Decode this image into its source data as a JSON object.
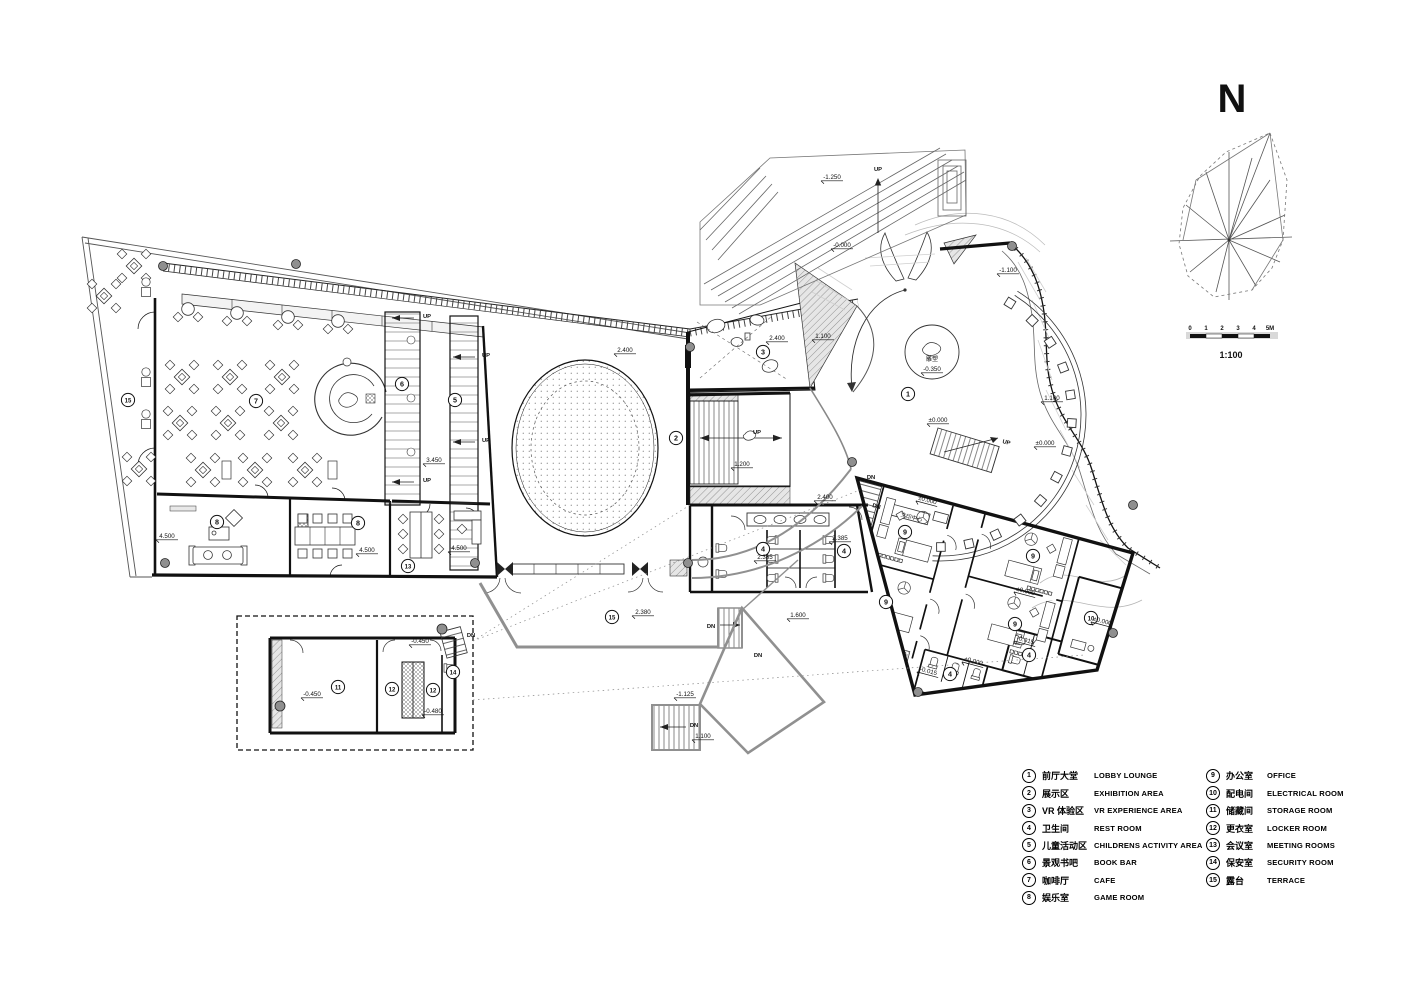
{
  "drawing": {
    "north_label": "N",
    "scale_ratio": "1:100",
    "scale_ticks": [
      "0",
      "1",
      "2",
      "3",
      "4",
      "5M"
    ],
    "colors": {
      "wall": "#1a1a1a",
      "gray_structure": "#909090",
      "light_fill": "#e8e8e8",
      "hatch": "#8a8a8a"
    }
  },
  "legend": {
    "items": [
      {
        "n": "1",
        "zh": "前厅大堂",
        "en": "LOBBY LOUNGE"
      },
      {
        "n": "2",
        "zh": "展示区",
        "en": "EXHIBITION AREA"
      },
      {
        "n": "3",
        "zh": "VR 体验区",
        "en": "VR EXPERIENCE AREA"
      },
      {
        "n": "4",
        "zh": "卫生间",
        "en": "REST ROOM"
      },
      {
        "n": "5",
        "zh": "儿童活动区",
        "en": "CHILDRENS ACTIVITY AREA"
      },
      {
        "n": "6",
        "zh": "景观书吧",
        "en": "BOOK BAR"
      },
      {
        "n": "7",
        "zh": "咖啡厅",
        "en": "CAFE"
      },
      {
        "n": "8",
        "zh": "娱乐室",
        "en": "GAME ROOM"
      },
      {
        "n": "9",
        "zh": "办公室",
        "en": "OFFICE"
      },
      {
        "n": "10",
        "zh": "配电间",
        "en": "ELECTRICAL ROOM"
      },
      {
        "n": "11",
        "zh": "储藏间",
        "en": "STORAGE ROOM"
      },
      {
        "n": "12",
        "zh": "更衣室",
        "en": "LOCKER ROOM"
      },
      {
        "n": "13",
        "zh": "会议室",
        "en": "MEETING ROOMS"
      },
      {
        "n": "14",
        "zh": "保安室",
        "en": "SECURITY ROOM"
      },
      {
        "n": "15",
        "zh": "露台",
        "en": "TERRACE"
      }
    ]
  },
  "plan": {
    "room_markers": [
      {
        "n": "1",
        "x": 908,
        "y": 394
      },
      {
        "n": "2",
        "x": 676,
        "y": 438
      },
      {
        "n": "3",
        "x": 763,
        "y": 352
      },
      {
        "n": "4",
        "x": 763,
        "y": 549
      },
      {
        "n": "4",
        "x": 844,
        "y": 551
      },
      {
        "n": "4",
        "x": 1029,
        "y": 655
      },
      {
        "n": "4",
        "x": 950,
        "y": 674
      },
      {
        "n": "5",
        "x": 455,
        "y": 400
      },
      {
        "n": "6",
        "x": 402,
        "y": 384
      },
      {
        "n": "7",
        "x": 256,
        "y": 401
      },
      {
        "n": "8",
        "x": 217,
        "y": 522
      },
      {
        "n": "8",
        "x": 358,
        "y": 523
      },
      {
        "n": "9",
        "x": 905,
        "y": 532
      },
      {
        "n": "9",
        "x": 886,
        "y": 602
      },
      {
        "n": "9",
        "x": 1033,
        "y": 556
      },
      {
        "n": "9",
        "x": 1015,
        "y": 624
      },
      {
        "n": "10",
        "x": 1091,
        "y": 618
      },
      {
        "n": "11",
        "x": 338,
        "y": 687
      },
      {
        "n": "12",
        "x": 392,
        "y": 689
      },
      {
        "n": "12",
        "x": 433,
        "y": 690
      },
      {
        "n": "13",
        "x": 408,
        "y": 566
      },
      {
        "n": "14",
        "x": 453,
        "y": 672
      },
      {
        "n": "15",
        "x": 128,
        "y": 400
      },
      {
        "n": "15",
        "x": 612,
        "y": 617
      }
    ],
    "levels": [
      {
        "v": "4.500",
        "x": 167,
        "y": 538
      },
      {
        "v": "4.500",
        "x": 367,
        "y": 552
      },
      {
        "v": "4.500",
        "x": 459,
        "y": 550
      },
      {
        "v": "3.450",
        "x": 434,
        "y": 462
      },
      {
        "v": "2.400",
        "x": 625,
        "y": 352
      },
      {
        "v": "1.200",
        "x": 742,
        "y": 466
      },
      {
        "v": "2.400",
        "x": 777,
        "y": 340
      },
      {
        "v": "1.100",
        "x": 823,
        "y": 338
      },
      {
        "v": "-1.250",
        "x": 832,
        "y": 179
      },
      {
        "v": "-0.000",
        "x": 842,
        "y": 247
      },
      {
        "v": "-1.100",
        "x": 1008,
        "y": 272
      },
      {
        "v": "1.100",
        "x": 1052,
        "y": 400
      },
      {
        "v": "±0.000",
        "x": 938,
        "y": 422
      },
      {
        "v": "-0.350",
        "x": 932,
        "y": 371
      },
      {
        "v": "±0.000",
        "x": 1045,
        "y": 445
      },
      {
        "v": "2.400",
        "x": 825,
        "y": 499
      },
      {
        "v": "2.385",
        "x": 765,
        "y": 559
      },
      {
        "v": "2.385",
        "x": 840,
        "y": 540
      },
      {
        "v": "2.380",
        "x": 643,
        "y": 614
      },
      {
        "v": "1.600",
        "x": 798,
        "y": 617
      },
      {
        "v": "-1.125",
        "x": 685,
        "y": 696
      },
      {
        "v": "1.100",
        "x": 703,
        "y": 738
      },
      {
        "v": "-0.450",
        "x": 312,
        "y": 696
      },
      {
        "v": "-0.450",
        "x": 420,
        "y": 643
      },
      {
        "v": "-0.480",
        "x": 433,
        "y": 713
      },
      {
        "v": "±0.000",
        "x": 927,
        "y": 502,
        "rot": 15
      },
      {
        "v": "±0.000",
        "x": 1025,
        "y": 593,
        "rot": 15
      },
      {
        "v": "±0.000",
        "x": 973,
        "y": 663,
        "rot": 15
      },
      {
        "v": "±0.000",
        "x": 1102,
        "y": 623,
        "rot": 15
      },
      {
        "v": "-0.015",
        "x": 1025,
        "y": 642,
        "rot": 15
      },
      {
        "v": "-0.015",
        "x": 928,
        "y": 673,
        "rot": 15
      }
    ],
    "flow_labels": [
      {
        "t": "UP",
        "x": 878,
        "y": 171
      },
      {
        "t": "UP",
        "x": 427,
        "y": 318
      },
      {
        "t": "UP",
        "x": 427,
        "y": 482
      },
      {
        "t": "UP",
        "x": 486,
        "y": 357
      },
      {
        "t": "UP",
        "x": 486,
        "y": 442
      },
      {
        "t": "UP",
        "x": 757,
        "y": 434
      },
      {
        "t": "UP",
        "x": 1006,
        "y": 444,
        "rot": 15
      },
      {
        "t": "DN",
        "x": 871,
        "y": 479
      },
      {
        "t": "DN",
        "x": 876,
        "y": 508,
        "rot": 15
      },
      {
        "t": "DN",
        "x": 711,
        "y": 628
      },
      {
        "t": "DN",
        "x": 694,
        "y": 727
      },
      {
        "t": "DN",
        "x": 758,
        "y": 657
      },
      {
        "t": "DN",
        "x": 471,
        "y": 637
      }
    ],
    "text_labels": [
      {
        "t": "雕塑",
        "x": 932,
        "y": 361,
        "size": 6
      },
      {
        "t": "文印中心",
        "x": 911,
        "y": 519,
        "size": 5.5,
        "rot": 15
      }
    ]
  }
}
